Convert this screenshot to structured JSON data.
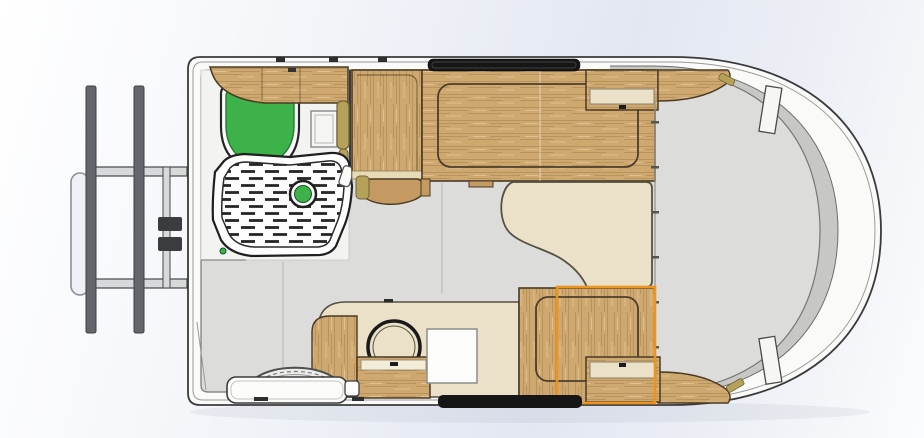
{
  "scene": {
    "type": "cad-floorplan-render",
    "subject": "caravan travel trailer - top view floor plan",
    "view": "top",
    "visible_text": "",
    "selection": {
      "component": "dinette-seat",
      "highlight_color": "#ec9420"
    }
  },
  "colors": {
    "bg_light": "#fbfcfd",
    "bg_blue": "#e3e7f1",
    "outline": "#3a3a3a",
    "wall_white": "#fafaf9",
    "liner_gray": "#c7c7c5",
    "floor_gray": "#dcdcda",
    "bathroom_white": "#f3f3f2",
    "wood": "#cfa86f",
    "wood_dark": "#c49a62",
    "wood_edge": "#4a3a24",
    "cream": "#eae1c8",
    "cream_edge": "#55503f",
    "khaki": "#b5a258",
    "khaki_edge": "#6e6136",
    "green": "#3db24a",
    "green_dark": "#1f7c2d",
    "black": "#161616",
    "orange": "#ec9420",
    "metal": "#64666b",
    "metal_light": "#d8d9db",
    "seam": "#b3b3b1"
  },
  "components": [
    {
      "id": 0,
      "name": "tow-hitch-frame",
      "label": "Tow hitch A-frame with twin rails"
    },
    {
      "id": 1,
      "name": "front-bumper",
      "label": "Front bumper rail"
    },
    {
      "id": 2,
      "name": "jockey-wheel",
      "label": "Jockey wheel / coupling"
    },
    {
      "id": 3,
      "name": "caravan-shell",
      "label": "Caravan body shell"
    },
    {
      "id": 4,
      "name": "bathroom-floor",
      "label": "Bathroom compartment"
    },
    {
      "id": 5,
      "name": "toilet",
      "label": "Cassette toilet (green lid)"
    },
    {
      "id": 6,
      "name": "overhead-cabinet-front",
      "label": "Front overhead cabinet"
    },
    {
      "id": 7,
      "name": "vanity-mirror",
      "label": "Vanity mirror cabinet"
    },
    {
      "id": 8,
      "name": "heater-flue",
      "label": "Water heater flue"
    },
    {
      "id": 9,
      "name": "shower-tray",
      "label": "Shower tray with duckboard"
    },
    {
      "id": 10,
      "name": "shower-drain",
      "label": "Shower drain"
    },
    {
      "id": 11,
      "name": "wardrobe",
      "label": "Wardrobe"
    },
    {
      "id": 12,
      "name": "wardrobe-door",
      "label": "Wardrobe door (open)"
    },
    {
      "id": 13,
      "name": "front-bed",
      "label": "Front bed / seating with mattress outline"
    },
    {
      "id": 14,
      "name": "overhead-locker-rear",
      "label": "Rear overhead locker"
    },
    {
      "id": 15,
      "name": "corner-shelf-top",
      "label": "Rear corner shelf (top)"
    },
    {
      "id": 16,
      "name": "corner-shelf-bottom",
      "label": "Rear corner shelf (bottom)"
    },
    {
      "id": 17,
      "name": "dining-table",
      "label": "Free-form dining table"
    },
    {
      "id": 18,
      "name": "kitchen-counter",
      "label": "Kitchen worktop"
    },
    {
      "id": 19,
      "name": "kitchen-sink",
      "label": "Round kitchen sink"
    },
    {
      "id": 20,
      "name": "stove",
      "label": "Cooktop"
    },
    {
      "id": 21,
      "name": "sink-cabinet",
      "label": "Sink base cabinet"
    },
    {
      "id": 22,
      "name": "kitchen-side-panel",
      "label": "Kitchen side panel"
    },
    {
      "id": 23,
      "name": "entry-step",
      "label": "Entry step"
    },
    {
      "id": 24,
      "name": "wheel-arch",
      "label": "Wheel arch"
    },
    {
      "id": 25,
      "name": "dinette-seat",
      "label": "Dinette seat (selected, orange highlight)"
    },
    {
      "id": 26,
      "name": "seat-drawer",
      "label": "Seat drawer"
    },
    {
      "id": 27,
      "name": "front-window",
      "label": "Top wall window"
    },
    {
      "id": 28,
      "name": "entry-door",
      "label": "Entry door"
    },
    {
      "id": 29,
      "name": "rear-lounge-floor",
      "label": "Rear lounge floor"
    }
  ]
}
